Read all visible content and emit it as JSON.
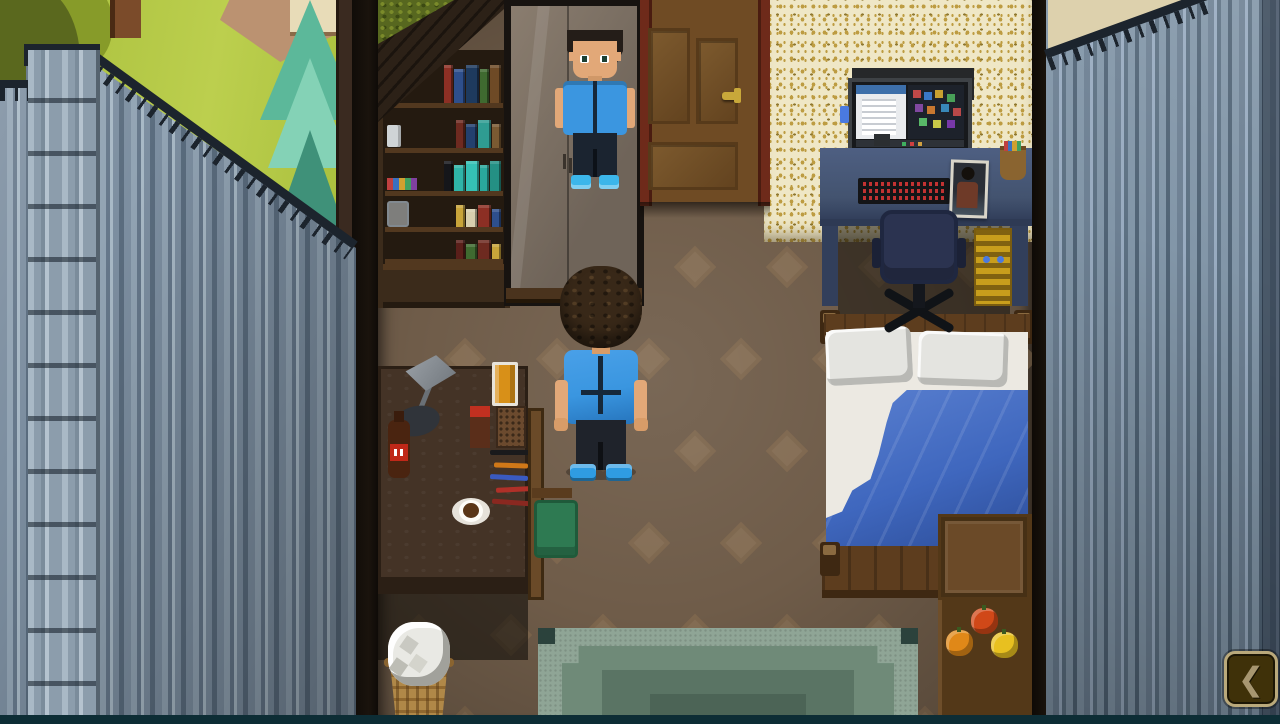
{
  "meta": {
    "scene": "bedroom-interior-topdown",
    "view": "top-down pixel art"
  },
  "hud": {
    "back_button": {
      "icon": "chevron-left-icon",
      "glyph": "❮"
    }
  },
  "palette": {
    "grass": "#a6bd3a",
    "grassLight": "#bccf4e",
    "canopyDark": "#5a681e",
    "canopyMid": "#879b29",
    "trunk": "#7b4b2a",
    "path": "#bb9271",
    "beigeWall": "#e8dcb8",
    "pine1": "#84d2b6",
    "pine2": "#5cb89a",
    "pine3": "#3f9179",
    "fenceA": "#7c8ea0",
    "fenceB": "#91a3b3",
    "fenceC": "#65778a",
    "fenceD": "#a7b8c5",
    "fenceE": "#5a6c7e",
    "pillarA": "#a9b9c6",
    "pillarB": "#8c9dac",
    "pillarC": "#7b8c9b",
    "pillarD": "#b5c3cf",
    "fenceEdge": "#1c242d",
    "outerWall": "#3a2a20",
    "shadowGap": "#1a130d",
    "floor": "#6f5c49",
    "stairsWood": "#2c2117",
    "moss": "#57671f",
    "shelfWood": "#3b2b1b",
    "shelfBack": "#241a10",
    "shelfFront": "#52381f",
    "mirrorFrame": "#171310",
    "mirrorGlassA": "#6f6459",
    "mirrorGlassB": "#8a7d6f",
    "wardrobeBase": "#4a331d",
    "doorFrameC": "#6e2a1a",
    "doorC": "#6f4b24",
    "doorPanelDark": "#573a1a",
    "doorPanelHi": "#7d5a2e",
    "handleGold": "#c8a83a",
    "wallpaper": "#efe7c6",
    "wallpaperGold": "#bd9c42",
    "wallpaperGoldDark": "#8f7830",
    "monitorFrame": "#3e4246",
    "monitorBack": "#26282a",
    "screenLight": "#e9ebee",
    "screenBlue": "#3d6faa",
    "screenDark": "#1d222b",
    "taskbar": "#2e3238",
    "deskBlueHi": "#4e5f82",
    "deskBlue": "#43536f",
    "deskBlueDark": "#323f5b",
    "keyboard": "#141517",
    "keyRed": "#c23232",
    "chairOffice": "#2b3350",
    "chairOfficeDark": "#1f2740",
    "chairBase": "#101317",
    "banner": "#c89e1c",
    "bannerDark": "#7a5c10",
    "bannerBlue": "#4a7ae0",
    "bedWood": "#5d3d1e",
    "bedWoodDark": "#3e2812",
    "bedKnob": "#8a6a40",
    "pillow": "#e4e4e0",
    "sheet": "#ece9e2",
    "blanketHi": "#5a80d0",
    "blanket": "#3f67be",
    "blanketLo": "#2c4c96",
    "dresserTop": "#6b4a28",
    "dresserDark": "#463015",
    "dresserFront": "#533818",
    "deskLeft": "#443326",
    "deskLeftDark": "#2b1f15",
    "lampDark": "#30343a",
    "juice": "#d89018",
    "colaBody": "#4a2410",
    "colaLabel": "#c02818",
    "coffeeBrown": "#5a3618",
    "saucer": "#e6e2da",
    "chairWoodC": "#6a4a28",
    "cushion": "#2e7a52",
    "cushionDark": "#1f5a3a",
    "basket": "#b08848",
    "basketDark": "#8a6430",
    "paper": "#e9e9e4",
    "rugOuter": "#8fa596",
    "rugMid": "#6f8a78",
    "rugInner": "#5a7464",
    "rugCore": "#4c6456",
    "rugCorner": "#2b423c",
    "hairC": "#382818",
    "skin": "#e2a878",
    "shirt": "#3a96e0",
    "shirtDark": "#16283a",
    "pants": "#1f232b",
    "shoes": "#2f9ce2",
    "mHair": "#241d18",
    "mShirt": "#3b96e0",
    "mPants": "#1b2430",
    "mShoes": "#3cb6ea",
    "wallA": "#8296a8",
    "wallB": "#6d8093",
    "wallC": "#98abc0",
    "wallD": "#5d7183",
    "ceilingBeige": "#ddd1ad",
    "bottomBar": "#0d2d35",
    "btnBg": "#3f3109",
    "btnBorder": "#baa97b",
    "btnGlyph": "#a79670"
  },
  "bookshelf": {
    "rows": [
      {
        "item": "apple",
        "spines": [
          "#8c2f24",
          "#2e4f8c",
          "#1e3a5e",
          "#3f6a30",
          "#6e4a26"
        ]
      },
      {
        "item": "cup",
        "spines": [
          "#6e2a20",
          "#23406e",
          "#2f9c92",
          "#7a5a32"
        ]
      },
      {
        "item": "potions",
        "spines": [
          "#15161a",
          "#2fb4a8",
          "#35c0b4",
          "#2aa89c",
          "#249084"
        ]
      },
      {
        "item": "jar",
        "spines": [
          "#c8a43a",
          "#d8cfae",
          "#8c2f24",
          "#2e4f8c"
        ]
      },
      {
        "item": "none",
        "spines": [
          "#5a1f1a",
          "#3f6a30",
          "#6e2a20",
          "#c8a43a"
        ]
      }
    ]
  },
  "dresser": {
    "fruits": [
      "#d04818",
      "#e08818",
      "#e8c020"
    ]
  },
  "scene": {
    "characters": [
      {
        "id": "player",
        "view": "back",
        "hair": "curly-brown",
        "shirt": "blue",
        "pants": "black",
        "shoes": "blue"
      },
      {
        "id": "mirror-reflection",
        "view": "front",
        "hair": "short-dark",
        "shirt": "blue",
        "pants": "black",
        "shoes": "blue"
      }
    ],
    "room_objects": [
      "bookshelf",
      "wardrobe-mirror",
      "door",
      "computer-desk",
      "office-chair",
      "bed",
      "dresser-with-fruits",
      "writing-desk",
      "wooden-chair",
      "waste-basket",
      "green-rug"
    ],
    "outdoor_objects": [
      "grass",
      "tree",
      "pine-tree",
      "dirt-path",
      "corrugated-metal-fence"
    ]
  }
}
